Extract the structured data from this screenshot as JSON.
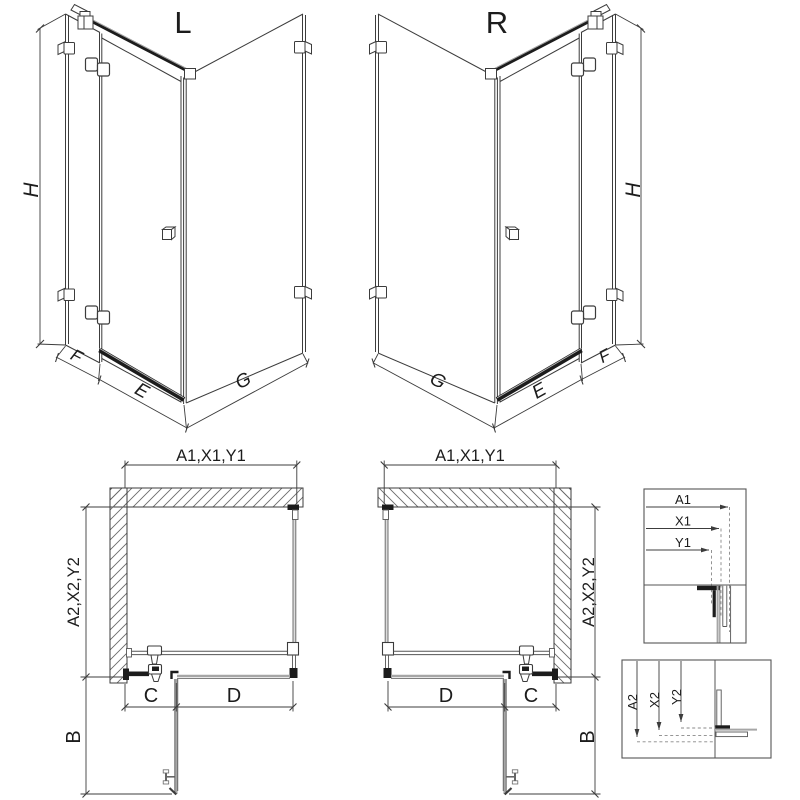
{
  "iso_left": {
    "variant": "L",
    "height": "H",
    "fixed_panel": "F",
    "door": "E",
    "side_panel": "G"
  },
  "iso_right": {
    "variant": "R",
    "height": "H",
    "fixed_panel": "F",
    "door": "E",
    "side_panel": "G"
  },
  "plan_left": {
    "width": "A1,X1,Y1",
    "depth": "A2,X2,Y2",
    "hinge_offset": "C",
    "door_width": "D",
    "door_swing": "B"
  },
  "plan_right": {
    "width": "A1,X1,Y1",
    "depth": "A2,X2,Y2",
    "hinge_offset": "C",
    "door_width": "D",
    "door_swing": "B"
  },
  "detail_width": {
    "a1": "A1",
    "x1": "X1",
    "y1": "Y1"
  },
  "detail_depth": {
    "a2": "A2",
    "x2": "X2",
    "y2": "Y2"
  },
  "colors": {
    "line": "#3c3c3c",
    "glass": "#a6a6a6",
    "dark": "#1c1c1c",
    "hatch": "#6a6a6a",
    "background": "#ffffff"
  }
}
